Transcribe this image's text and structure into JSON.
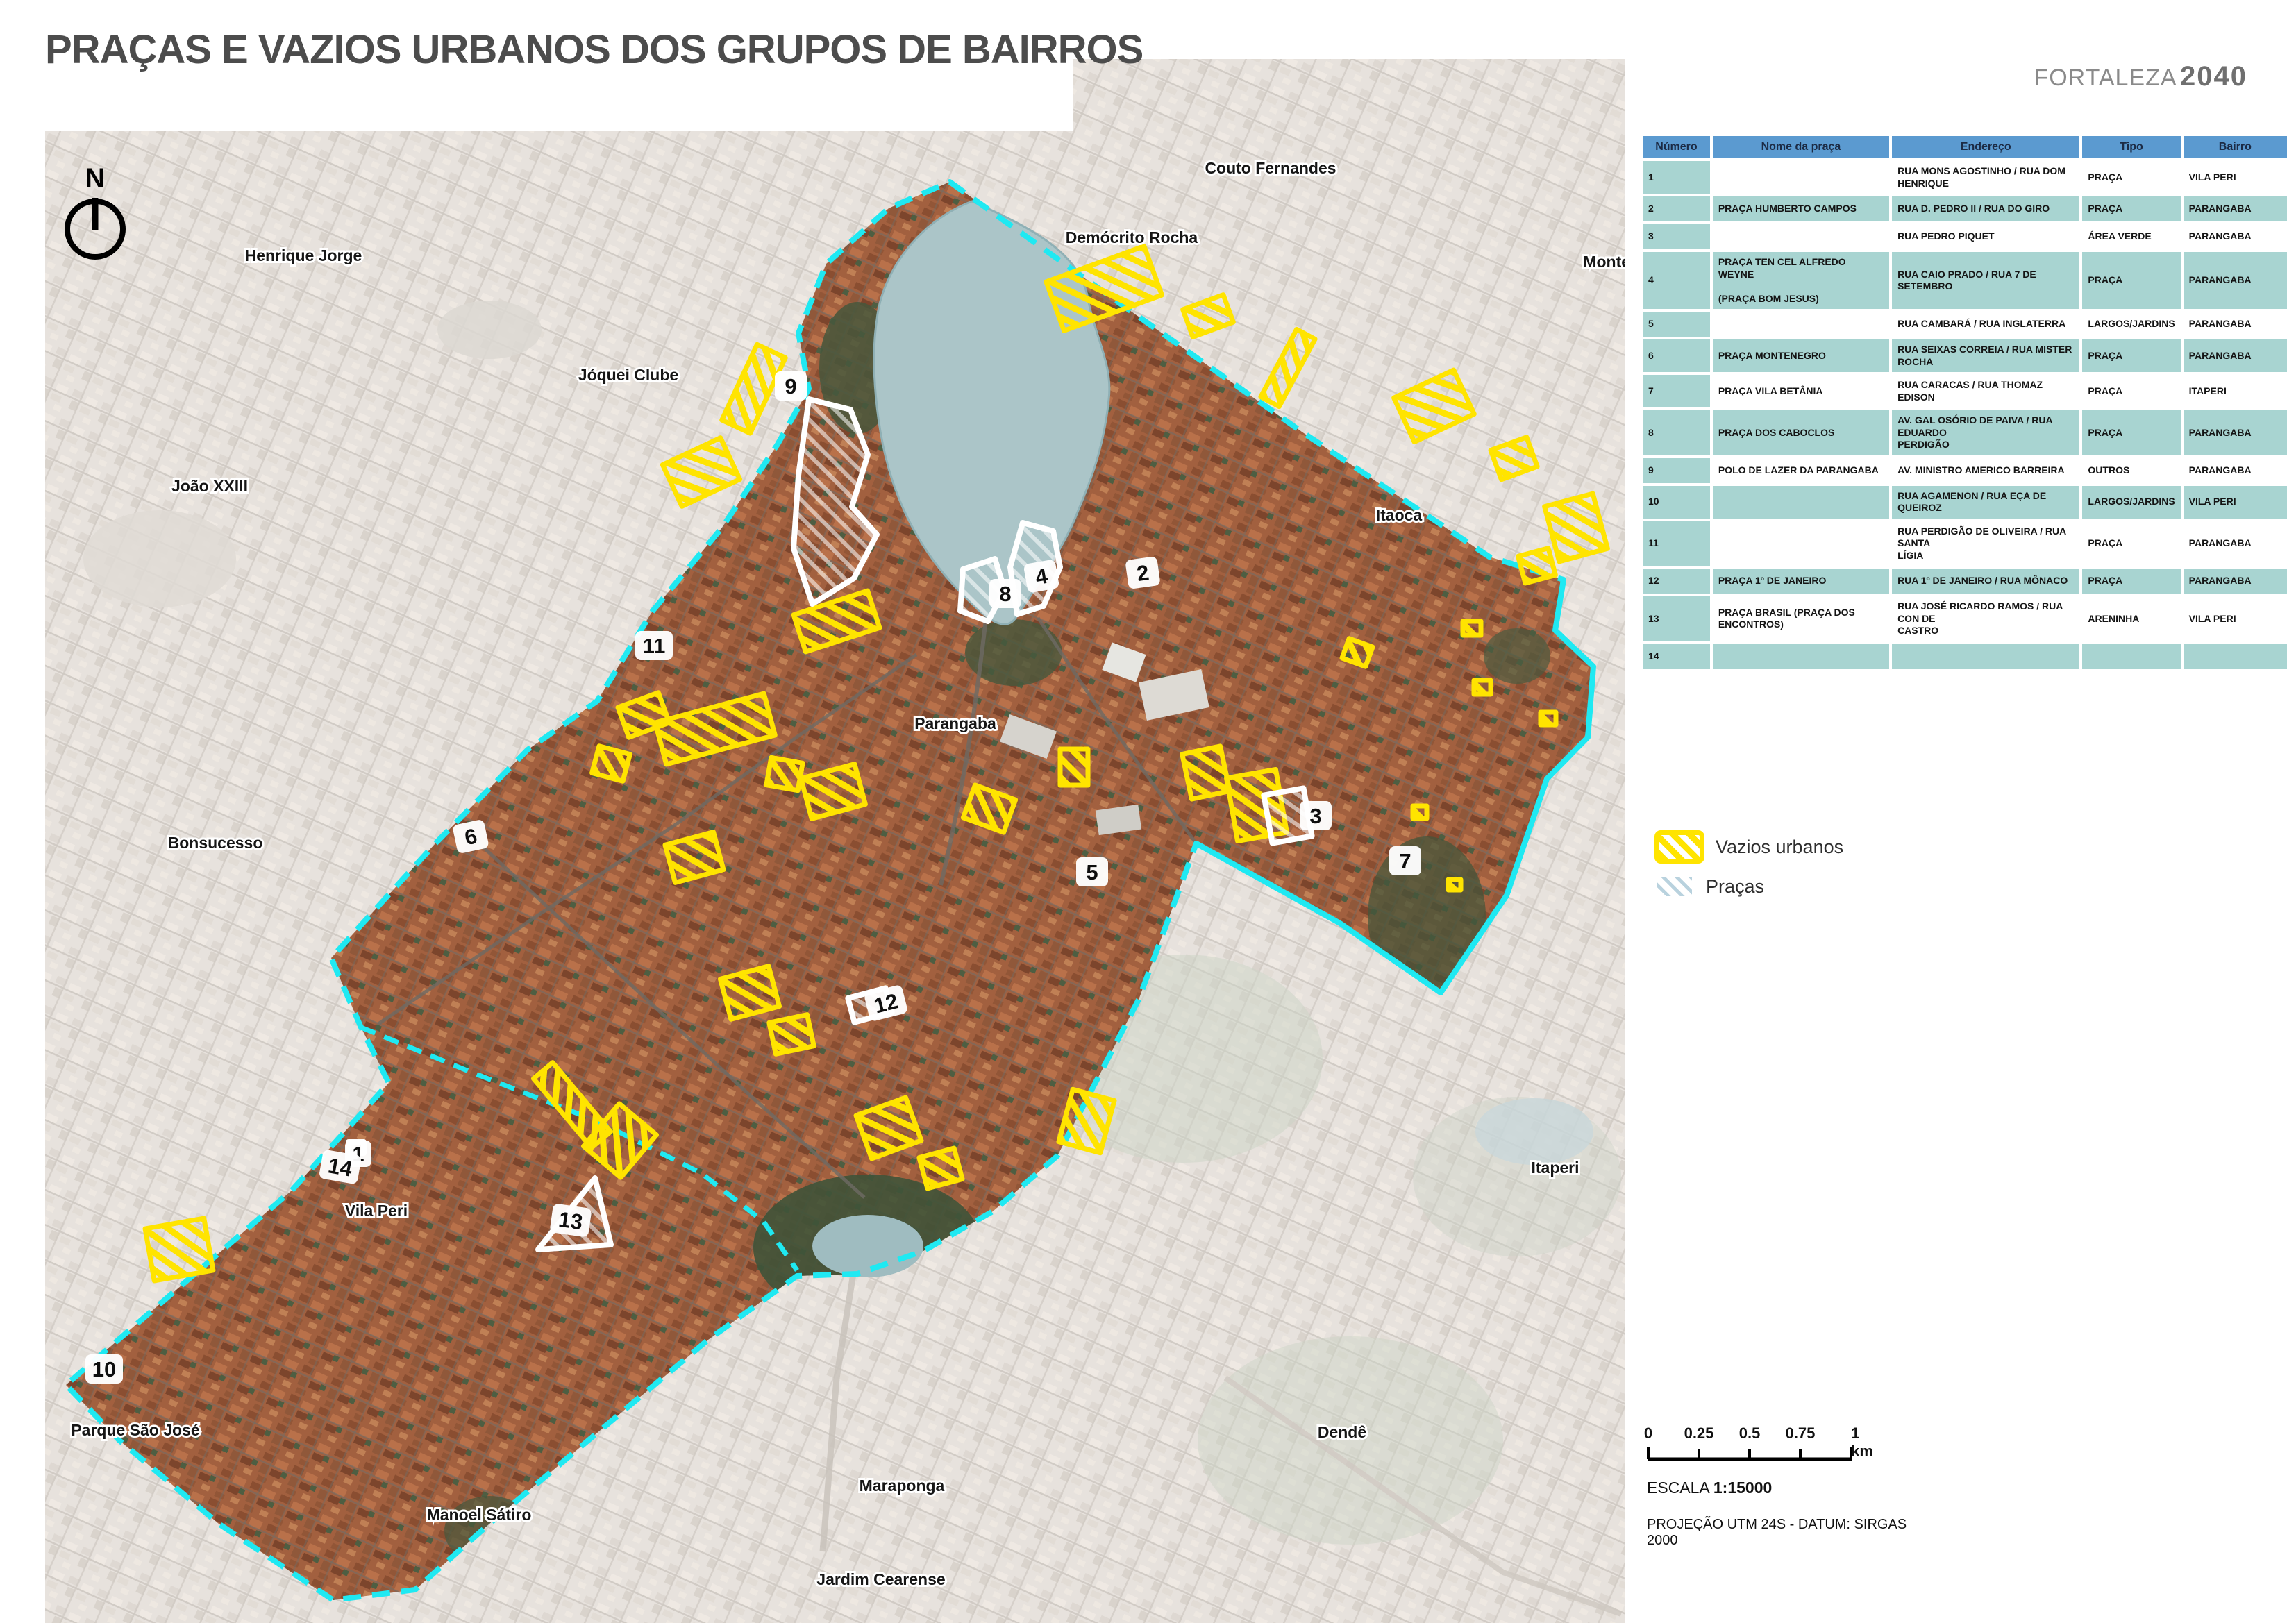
{
  "header": {
    "title": "PRAÇAS E VAZIOS URBANOS DOS GRUPOS DE BAIRROS",
    "brand_name": "FORTALEZA",
    "brand_year": "2040"
  },
  "map": {
    "north_label": "N",
    "labels": [
      {
        "text": "Couto Fernandes"
      },
      {
        "text": "Demócrito Rocha"
      },
      {
        "text": "Henrique Jorge"
      },
      {
        "text": "Jóquei Clube"
      },
      {
        "text": "João XXIII"
      },
      {
        "text": "Montese"
      },
      {
        "text": "Itaoca"
      },
      {
        "text": "Parangaba"
      },
      {
        "text": "Bonsucesso"
      },
      {
        "text": "Vila Peri"
      },
      {
        "text": "Maraponga"
      },
      {
        "text": "Manoel Sátiro"
      },
      {
        "text": "Parque São José"
      },
      {
        "text": "Jardim Cearense"
      },
      {
        "text": "Dendê"
      },
      {
        "text": "Itaperi"
      }
    ],
    "markers": [
      {
        "n": "1"
      },
      {
        "n": "2"
      },
      {
        "n": "3"
      },
      {
        "n": "4"
      },
      {
        "n": "5"
      },
      {
        "n": "6"
      },
      {
        "n": "7"
      },
      {
        "n": "8"
      },
      {
        "n": "9"
      },
      {
        "n": "10"
      },
      {
        "n": "11"
      },
      {
        "n": "12"
      },
      {
        "n": "13"
      },
      {
        "n": "14"
      }
    ],
    "colors": {
      "boundary": "#1fe9f2",
      "vazios": "#ffe400",
      "pracas": "#ffffff",
      "water": "#abc5c8"
    }
  },
  "table": {
    "columns": [
      "Número",
      "Nome da praça",
      "Endereço",
      "Tipo",
      "Bairro"
    ],
    "rows": [
      {
        "numero": "1",
        "nome": "",
        "endereco": "RUA MONS AGOSTINHO / RUA DOM\nHENRIQUE",
        "tipo": "PRAÇA",
        "bairro": "VILA PERI"
      },
      {
        "numero": "2",
        "nome": "PRAÇA HUMBERTO CAMPOS",
        "endereco": "RUA D. PEDRO II / RUA DO GIRO",
        "tipo": "PRAÇA",
        "bairro": "PARANGABA"
      },
      {
        "numero": "3",
        "nome": "",
        "endereco": "RUA PEDRO PIQUET",
        "tipo": "ÁREA VERDE",
        "bairro": "PARANGABA"
      },
      {
        "numero": "4",
        "nome": "PRAÇA TEN CEL ALFREDO WEYNE\n\n(PRAÇA BOM JESUS)",
        "endereco": "RUA CAIO PRADO / RUA 7 DE SETEMBRO",
        "tipo": "PRAÇA",
        "bairro": "PARANGABA"
      },
      {
        "numero": "5",
        "nome": "",
        "endereco": "RUA CAMBARÁ / RUA INGLATERRA",
        "tipo": "LARGOS/JARDINS",
        "bairro": "PARANGABA"
      },
      {
        "numero": "6",
        "nome": "PRAÇA MONTENEGRO",
        "endereco": "RUA SEIXAS CORREIA / RUA MISTER\nROCHA",
        "tipo": "PRAÇA",
        "bairro": "PARANGABA"
      },
      {
        "numero": "7",
        "nome": "PRAÇA VILA BETÂNIA",
        "endereco": "RUA CARACAS / RUA THOMAZ EDISON",
        "tipo": "PRAÇA",
        "bairro": "ITAPERI"
      },
      {
        "numero": "8",
        "nome": "PRAÇA DOS CABOCLOS",
        "endereco": "AV. GAL OSÓRIO DE PAIVA / RUA EDUARDO\nPERDIGÃO",
        "tipo": "PRAÇA",
        "bairro": "PARANGABA"
      },
      {
        "numero": "9",
        "nome": "POLO DE LAZER DA PARANGABA",
        "endereco": "AV. MINISTRO AMERICO BARREIRA",
        "tipo": "OUTROS",
        "bairro": "PARANGABA"
      },
      {
        "numero": "10",
        "nome": "",
        "endereco": "RUA AGAMENON / RUA EÇA DE\nQUEIROZ",
        "tipo": "LARGOS/JARDINS",
        "bairro": "VILA PERI"
      },
      {
        "numero": "11",
        "nome": "",
        "endereco": "RUA PERDIGÃO DE OLIVEIRA / RUA SANTA\nLÍGIA",
        "tipo": "PRAÇA",
        "bairro": "PARANGABA"
      },
      {
        "numero": "12",
        "nome": "PRAÇA 1º DE JANEIRO",
        "endereco": "RUA 1º DE JANEIRO / RUA MÔNACO",
        "tipo": "PRAÇA",
        "bairro": "PARANGABA"
      },
      {
        "numero": "13",
        "nome": "PRAÇA BRASIL (PRAÇA DOS ENCONTROS)",
        "endereco": "RUA JOSÉ RICARDO RAMOS / RUA CON DE\nCASTRO",
        "tipo": "ARENINHA",
        "bairro": "VILA PERI"
      },
      {
        "numero": "14",
        "nome": "",
        "endereco": "",
        "tipo": "",
        "bairro": ""
      }
    ]
  },
  "legend": {
    "items": [
      {
        "label": "Vazios urbanos"
      },
      {
        "label": "Praças"
      }
    ]
  },
  "scalebar": {
    "ticks": [
      "0",
      "0.25",
      "0.5",
      "0.75",
      "1 km"
    ],
    "escala_label": "ESCALA",
    "escala_value": "1:15000",
    "projecao": "PROJEÇÃO UTM 24S - DATUM: SIRGAS 2000"
  }
}
